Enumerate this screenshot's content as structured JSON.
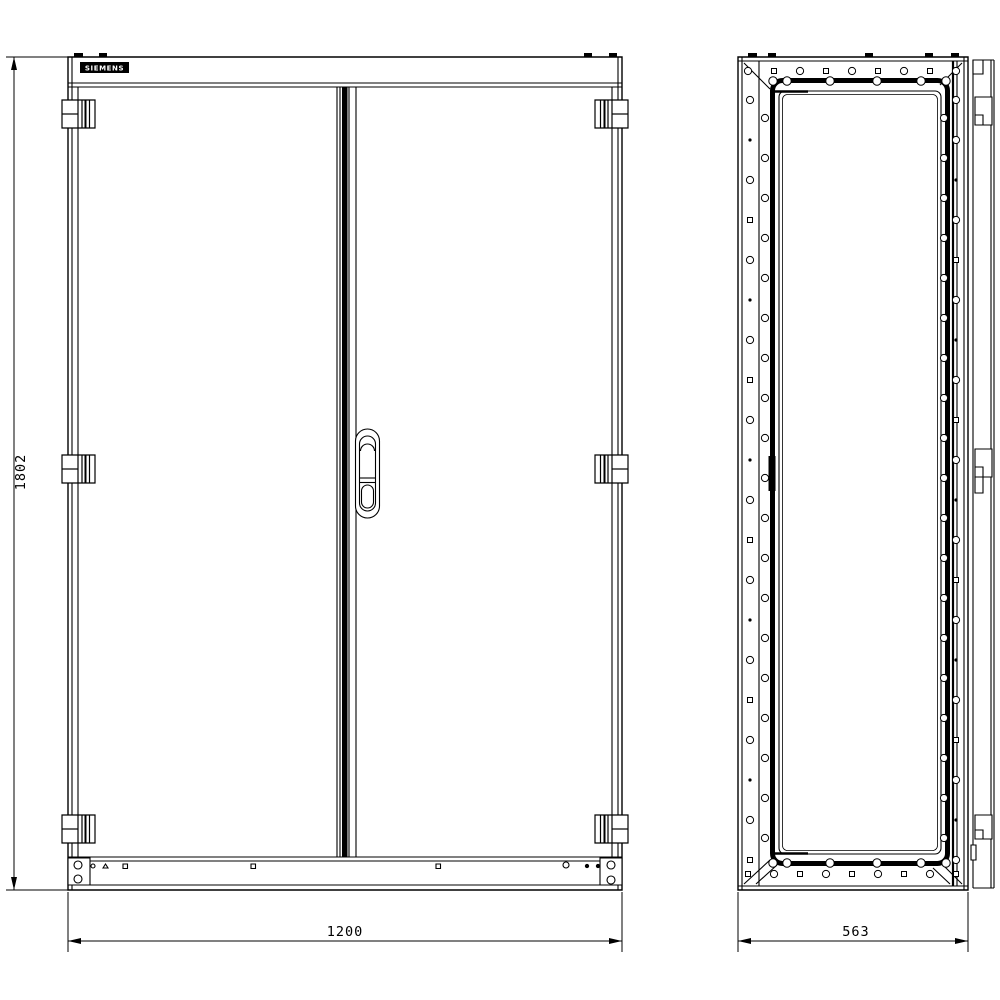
{
  "drawing": {
    "logo_text": "SIEMENS",
    "dim_height": "1802",
    "dim_width": "1200",
    "dim_depth": "563",
    "colors": {
      "line": "#000000",
      "background": "#ffffff"
    }
  }
}
